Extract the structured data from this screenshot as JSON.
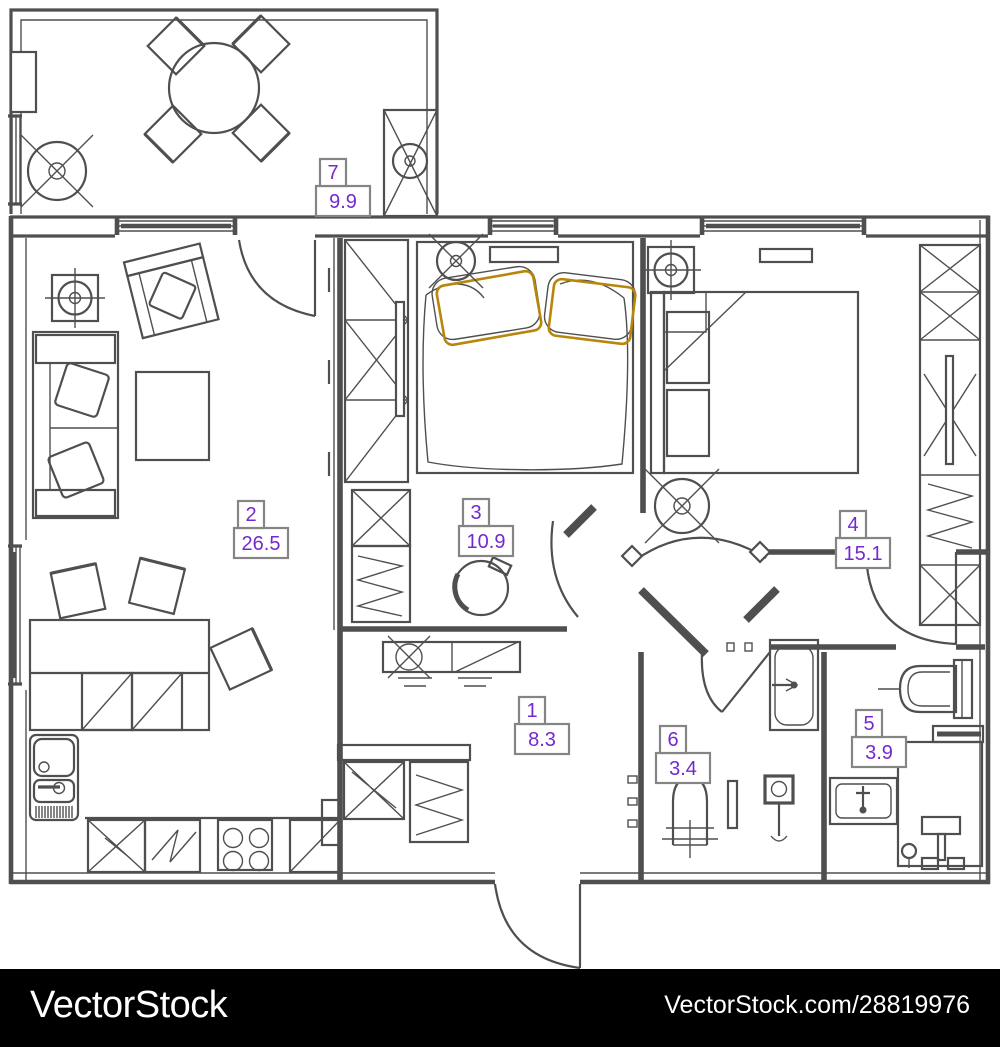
{
  "watermark": {
    "brand": "VectorStock",
    "credit": "VectorStock.com/28819976"
  },
  "rooms": [
    {
      "number": "1",
      "area": "8.3"
    },
    {
      "number": "2",
      "area": "26.5"
    },
    {
      "number": "3",
      "area": "10.9"
    },
    {
      "number": "4",
      "area": "15.1"
    },
    {
      "number": "5",
      "area": "3.9"
    },
    {
      "number": "6",
      "area": "3.4"
    },
    {
      "number": "7",
      "area": "9.9"
    }
  ],
  "colors": {
    "line": "#4f4f4f",
    "label": "#7429cf",
    "pillow": "#b8860b",
    "watermark_bg": "#000000",
    "watermark_text": "#ffffff",
    "bg": "#ffffff"
  }
}
